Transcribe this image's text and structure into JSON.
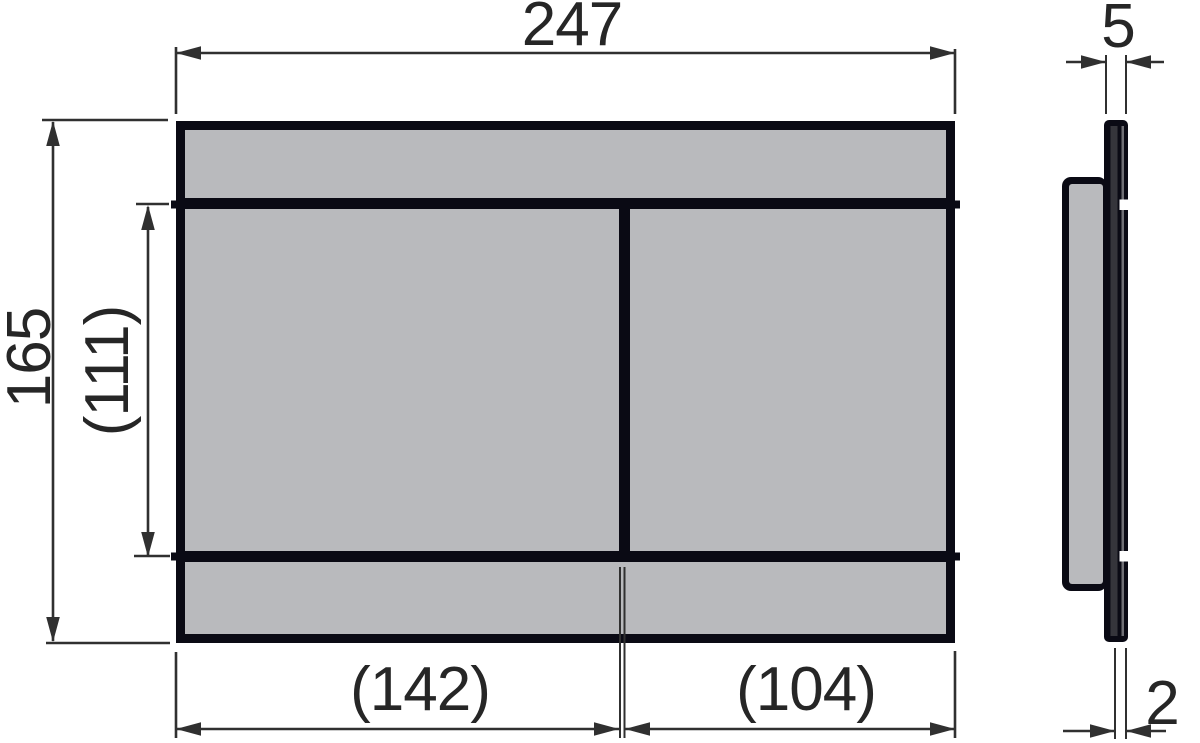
{
  "drawing": {
    "type": "technical-dimension-drawing",
    "views": {
      "front": {
        "description": "front view of rectangular flush plate with two buttons",
        "dimensions": {
          "overall_width": "247",
          "overall_height": "165",
          "button_field_height": "(111)",
          "left_button_width": "(142)",
          "right_button_width": "(104)"
        }
      },
      "side": {
        "description": "side profile view of plate with rear housing",
        "dimensions": {
          "plate_thickness": "5",
          "edge_thickness": "2"
        }
      }
    },
    "colors": {
      "background": "#ffffff",
      "panel_gray": "#b9babd",
      "outline_black": "#0a0a14",
      "dimension_line": "#303030",
      "dimension_text": "#262626"
    }
  }
}
